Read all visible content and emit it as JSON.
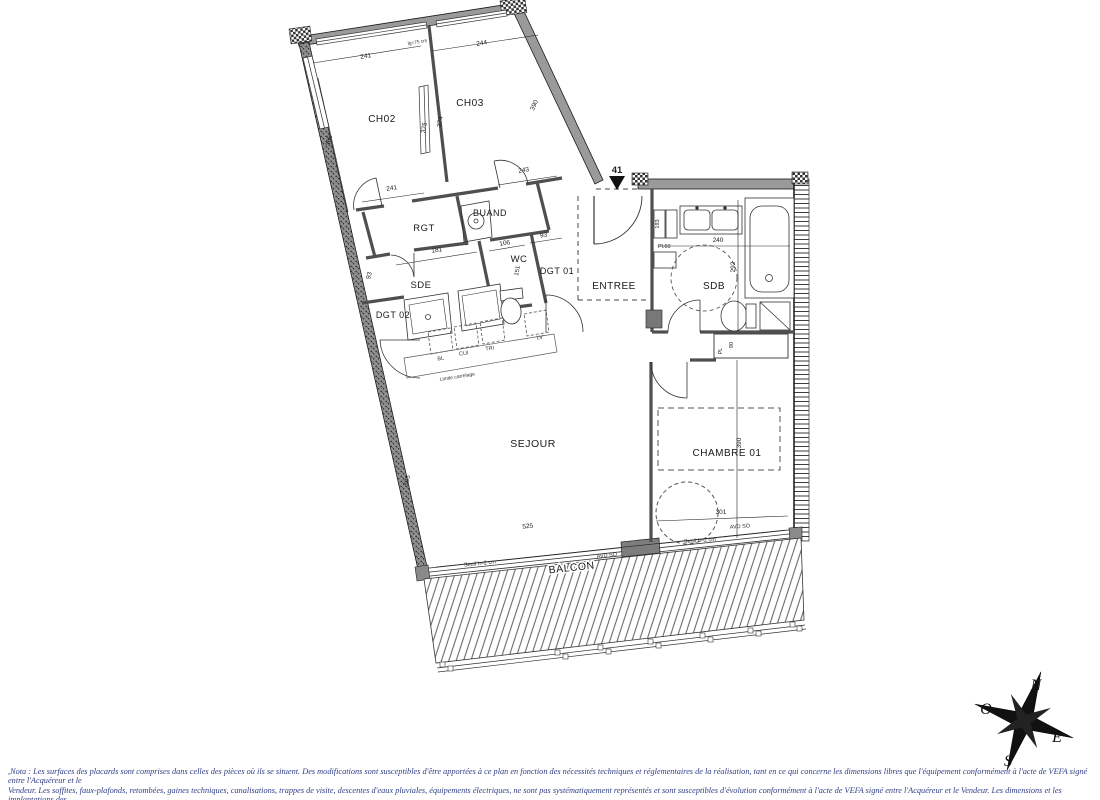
{
  "plan": {
    "unit": {
      "number": "41"
    },
    "rooms": {
      "ch02": "CH02",
      "ch03": "CH03",
      "rgt": "RGT",
      "buand": "BUAND",
      "wc": "WC",
      "dgt01": "DGT 01",
      "sde": "SDE",
      "dgt02": "DGT 02",
      "entree": "ENTREE",
      "sdb": "SDB",
      "sejour": "SEJOUR",
      "chambre01": "CHAMBRE 01",
      "balcon": "BALCON"
    },
    "dims": {
      "ch02_top": "241",
      "ch03_top": "244",
      "ch02_bot": "241",
      "ch03_bot": "243",
      "ch02_left": "366",
      "part_left": "375",
      "part_right": "374",
      "ch03_right": "390",
      "sde_left": "93",
      "sde_w": "181",
      "wc_w": "106",
      "dgt01_top": "93",
      "wc_h": "151",
      "sdb_w": "240",
      "sdb_h": "292",
      "cab_h": "193",
      "pl60": "Pl.60",
      "pl": "PL",
      "pl90": "90",
      "ch01_w": "301",
      "ch01_h": "390",
      "sej_w": "525",
      "sej_h": "505"
    },
    "annotations": {
      "lg75": "lg=75 cm",
      "limite": "Limite carrelage",
      "seuil_sejour": "Seuil h=2 cm",
      "seuil_ch": "Seuil h=2 cm",
      "avd_sejour": "AVD SO",
      "avd_ch": "AVD SO",
      "bl": "BL",
      "cui": "CUI",
      "tri": "TRI",
      "lv": "LV"
    },
    "compass": {
      "n": "N",
      "e": "E",
      "s": "S",
      "o": "O"
    },
    "footer": {
      "line1": ",Nota : Les surfaces des placards sont comprises dans celles des pièces où ils se situent. Des modifications sont susceptibles d'être apportées à ce plan en fonction des nécessités techniques et réglementaires de la réalisation, tant en ce qui concerne les dimensions libres que l'équipement conformément à l'acte de VEFA signé entre l'Acquéreur et le",
      "line2": "Vendeur. Les soffites, faux-plafonds, retombées, gaines techniques, canalisations, trappes de visite, descentes d'eaux pluviales, équipements électriques, ne sont pas systématiquement représentés et sont susceptibles d'évolution  conformément à l'acte de VEFA signé entre l'Acquéreur et le Vendeur. Les dimensions et les implantations des",
      "line3": "appareils de chauffage, lorsqu'ils sont représentés, sont indicatifs et seront soumis à la conformité de l'étude thermique"
    }
  }
}
